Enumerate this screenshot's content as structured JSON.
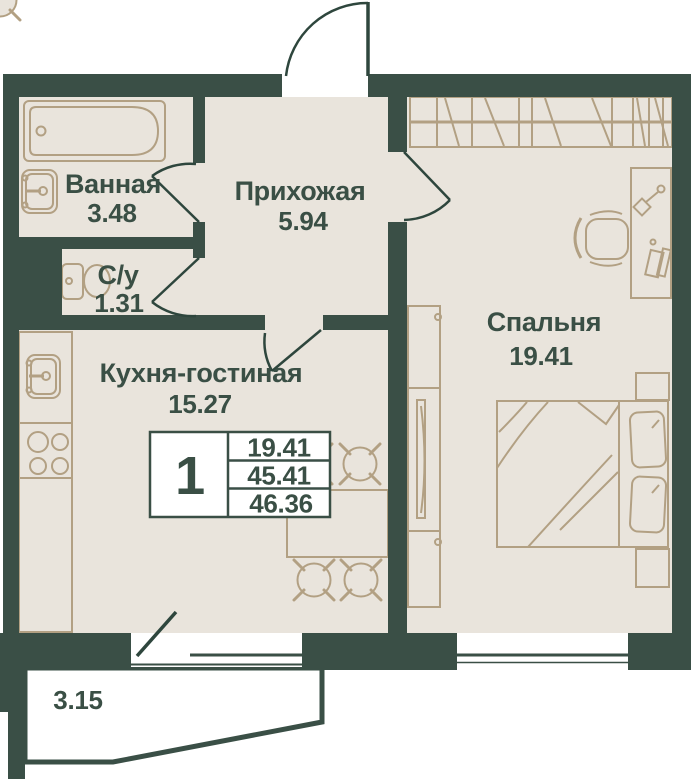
{
  "unit_info": {
    "rooms_count": "1",
    "rows": [
      "19.41",
      "45.41",
      "46.36"
    ]
  },
  "rooms": {
    "bathroom": {
      "label": "Ванная",
      "area": "3.48"
    },
    "wc": {
      "label": "С/у",
      "area": "1.31"
    },
    "hallway": {
      "label": "Прихожая",
      "area": "5.94"
    },
    "kitchen_living": {
      "label": "Кухня-гостиная",
      "area": "15.27"
    },
    "bedroom": {
      "label": "Спальня",
      "area": "19.41"
    },
    "balcony": {
      "area": "3.15"
    }
  },
  "colors": {
    "wall": "#3A4F46",
    "floor": "#E9E4DC",
    "furniture": "#B2A083",
    "text": "#3A4F45",
    "background": "#FFFFFF"
  }
}
